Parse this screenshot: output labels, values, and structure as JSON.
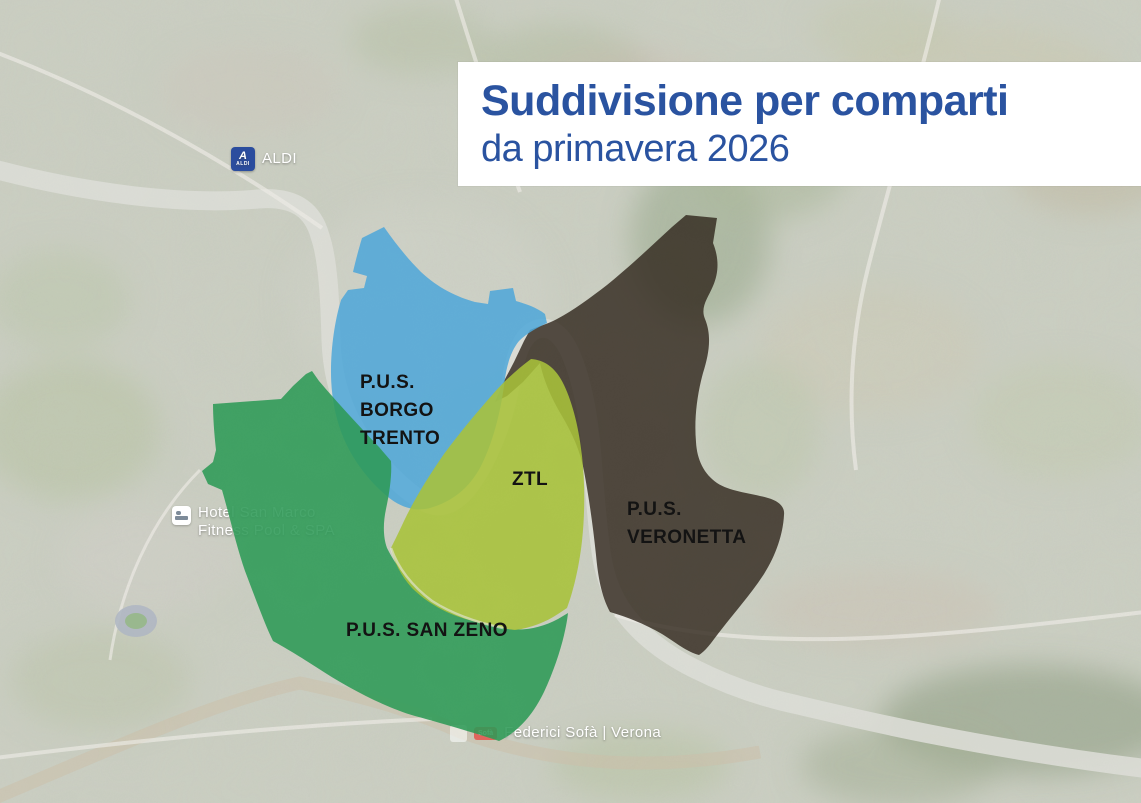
{
  "title_card": {
    "title": "Suddivisione per comparti",
    "subtitle": "da primavera 2026",
    "text_color": "#2a53a0",
    "background": "#ffffff"
  },
  "zones": [
    {
      "id": "borgo-trento",
      "name": "P.U.S. Borgo Trento",
      "label_lines": [
        "P.U.S.",
        "BORGO",
        "TRENTO"
      ],
      "color": "#4ea6d9"
    },
    {
      "id": "veronetta",
      "name": "P.U.S. Veronetta",
      "label_lines": [
        "P.U.S.",
        "VERONETTA"
      ],
      "color": "#2f261b"
    },
    {
      "id": "ztl",
      "name": "ZTL",
      "label_lines": [
        "ZTL"
      ],
      "color": "#a8c13a"
    },
    {
      "id": "san-zeno",
      "name": "P.U.S. San Zeno",
      "label_lines": [
        "P.U.S. SAN ZENO"
      ],
      "color": "#2d9a56"
    }
  ],
  "landmarks": {
    "aldi": {
      "label": "ALDI",
      "logo_letter": "A",
      "logo_text": "ALDI",
      "logo_color": "#2b4d9e"
    },
    "hotel": {
      "line1": "Hotel San Marco",
      "line2": "Fitness Pool & SPA"
    },
    "federici": {
      "label": "Federici Sofà | Verona",
      "badge": "Sofà",
      "badge_color": "#e0655c"
    }
  }
}
